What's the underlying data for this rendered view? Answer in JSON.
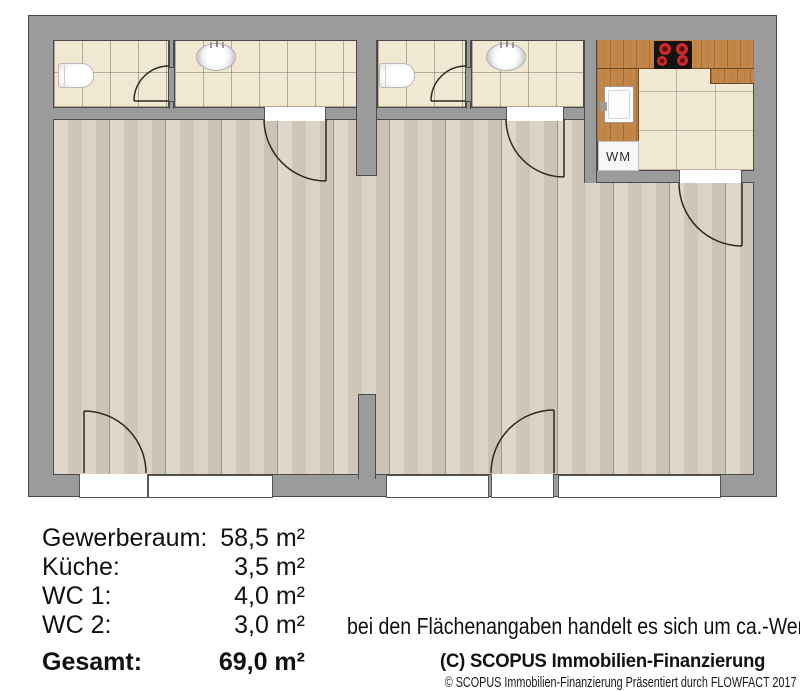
{
  "plan": {
    "washing_machine_label": "WM",
    "rooms": [
      "Gewerberaum",
      "Küche",
      "WC 1",
      "WC 2"
    ],
    "fixtures": [
      "toilet-icon",
      "washbasin-icon",
      "stove-icon",
      "kitchen-sink-icon",
      "washing-machine-icon",
      "door-swing-arc"
    ]
  },
  "legend": {
    "rows": [
      {
        "label": "Gewerberaum:",
        "value": "58,5 m²"
      },
      {
        "label": "Küche:",
        "value": "3,5 m²"
      },
      {
        "label": "WC 1:",
        "value": "4,0 m²"
      },
      {
        "label": "WC 2:",
        "value": "3,0 m²"
      }
    ],
    "total": {
      "label": "Gesamt:",
      "value": "69,0 m²"
    },
    "note": "bei den Flächenangaben handelt es sich um ca.-Werte"
  },
  "footer": {
    "copyright": "(C) SCOPUS Immobilien-Finanzierung",
    "credit": "© SCOPUS Immobilien-Finanzierung Präsentiert durch FLOWFACT 2017"
  },
  "colors": {
    "wall_gray": "#9b9b9b",
    "outline": "#4a4a4a",
    "wc_tile": "#f1e8d4",
    "kitchen_tile": "#f2e9d5",
    "wood_floor": "#d8cfc1",
    "counter_wood": "#c28648",
    "burner_red": "#cc2a2a",
    "door_stroke": "#33281d",
    "background": "#ffffff"
  }
}
